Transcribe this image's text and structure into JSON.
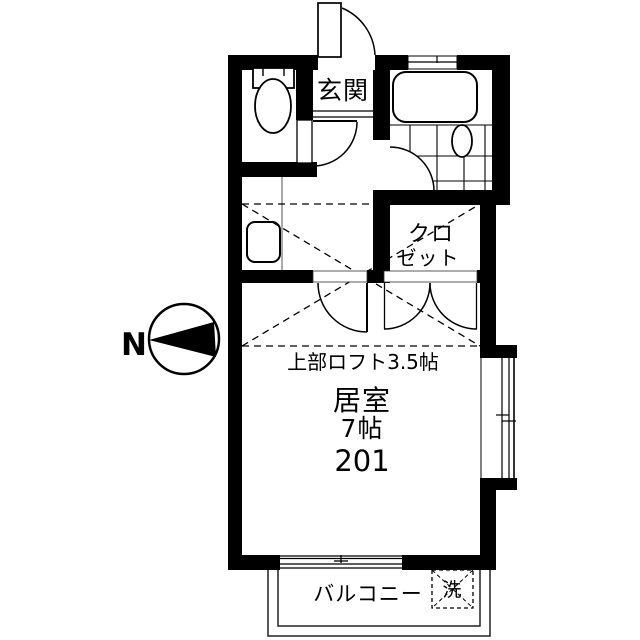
{
  "colors": {
    "ink": "#000000",
    "bg": "#ffffff",
    "thin_line": "#222222"
  },
  "floor_plan": {
    "compass_north": "N",
    "labels": {
      "entrance": "玄関",
      "closet_line1": "クロ",
      "closet_line2": "ゼット",
      "loft_note": "上部ロフト3.5帖",
      "room_name": "居室",
      "room_size": "7帖",
      "unit_number": "201",
      "balcony": "バルコニー",
      "washer": "洗"
    }
  }
}
